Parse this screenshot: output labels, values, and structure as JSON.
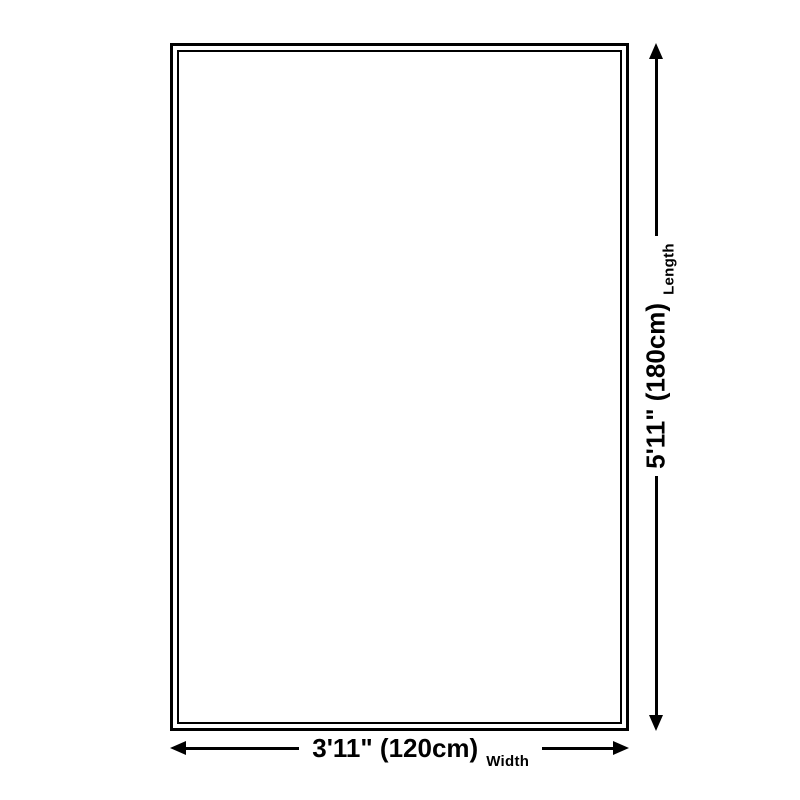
{
  "diagram": {
    "length": {
      "value": "5'11\" (180cm)",
      "caption": "Length"
    },
    "width": {
      "value": "3'11\" (120cm)",
      "caption": "Width"
    },
    "colors": {
      "line": "#000000",
      "background": "#ffffff"
    }
  }
}
